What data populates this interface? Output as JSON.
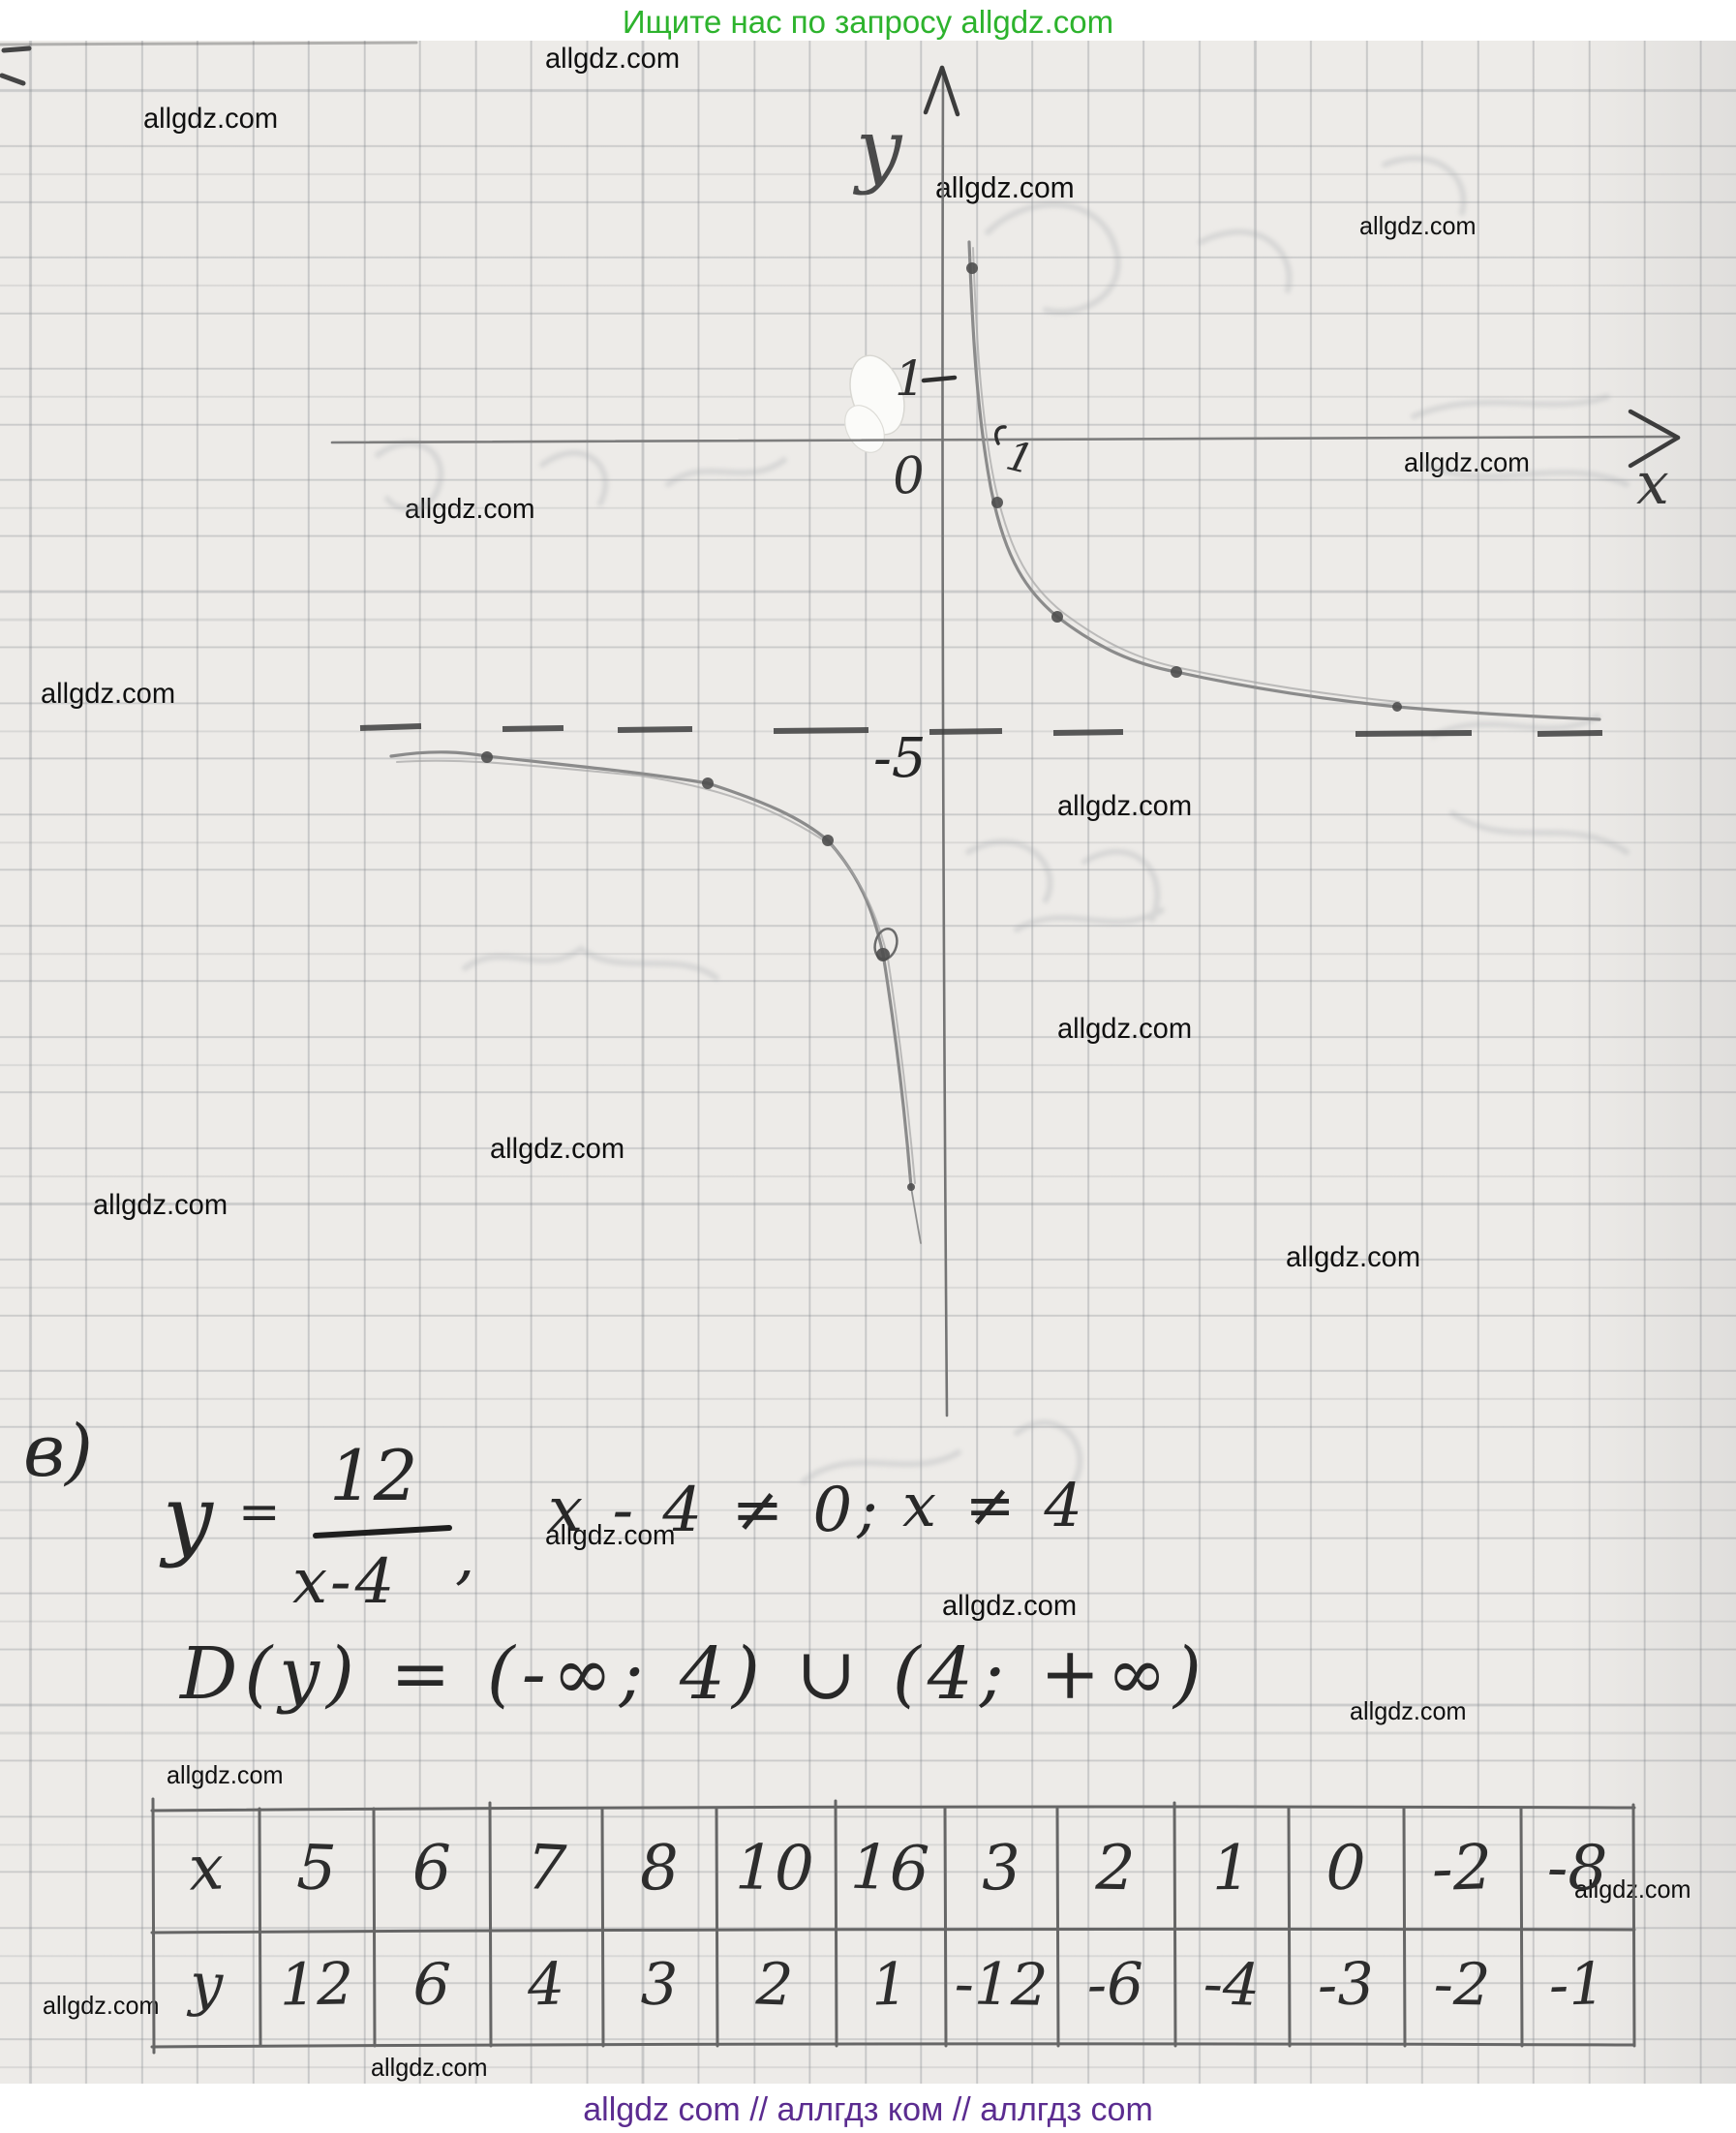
{
  "header": {
    "promo_text": "Ищите нас по запросу allgdz.com",
    "color": "#2db32d"
  },
  "watermark": {
    "text": "allgdz.com",
    "color": "#101010",
    "positions": [
      {
        "x": 563,
        "y": 44,
        "s": 30
      },
      {
        "x": 148,
        "y": 106,
        "s": 30
      },
      {
        "x": 966,
        "y": 176,
        "s": 31
      },
      {
        "x": 1404,
        "y": 218,
        "s": 26
      },
      {
        "x": 1450,
        "y": 462,
        "s": 28
      },
      {
        "x": 418,
        "y": 510,
        "s": 29
      },
      {
        "x": 42,
        "y": 700,
        "s": 30
      },
      {
        "x": 1092,
        "y": 816,
        "s": 30
      },
      {
        "x": 1092,
        "y": 1046,
        "s": 30
      },
      {
        "x": 506,
        "y": 1170,
        "s": 30
      },
      {
        "x": 96,
        "y": 1228,
        "s": 30
      },
      {
        "x": 1328,
        "y": 1282,
        "s": 30
      },
      {
        "x": 563,
        "y": 1570,
        "s": 29
      },
      {
        "x": 973,
        "y": 1642,
        "s": 30
      },
      {
        "x": 1394,
        "y": 1752,
        "s": 26
      },
      {
        "x": 172,
        "y": 1818,
        "s": 26
      },
      {
        "x": 1626,
        "y": 1936,
        "s": 26
      },
      {
        "x": 44,
        "y": 2056,
        "s": 26
      },
      {
        "x": 383,
        "y": 2120,
        "s": 26
      }
    ]
  },
  "graph": {
    "y_axis_label": "y",
    "x_axis_label": "x",
    "origin_label": "0",
    "y_unit_tick_label": "1",
    "x_unit_tick_label": "1",
    "dashed_level_label": "-5"
  },
  "work": {
    "part_label": "в)",
    "function_symbol": "y",
    "equals_sign": "=",
    "fraction_numerator": "12",
    "fraction_denominator": "x-4",
    "comma": ",",
    "condition": "x - 4 ≠ 0;",
    "conclusion": "x ≠ 4",
    "domain_line": "D(y) = (-∞; 4) ∪ (4; +∞)"
  },
  "table": {
    "row_labels": [
      "x",
      "y"
    ],
    "x_row": [
      "5",
      "6",
      "7",
      "8",
      "10",
      "16",
      "3",
      "2",
      "1",
      "0",
      "-2",
      "-8"
    ],
    "y_row": [
      "12",
      "6",
      "4",
      "3",
      "2",
      "1",
      "-12",
      "-6",
      "-4",
      "-3",
      "-2",
      "-1"
    ]
  },
  "chart_data": {
    "type": "line",
    "function": "y = 12/(x-4)",
    "series": [
      {
        "name": "branch x > 4",
        "x": [
          5,
          6,
          7,
          8,
          10,
          16
        ],
        "y": [
          12,
          6,
          4,
          3,
          2,
          1
        ]
      },
      {
        "name": "branch x < 4",
        "x": [
          3,
          2,
          1,
          0,
          -2,
          -8
        ],
        "y": [
          -12,
          -6,
          -4,
          -3,
          -2,
          -1
        ]
      }
    ],
    "axis_annotations": [
      "y",
      "x",
      "0",
      "1",
      "1",
      "-5"
    ],
    "grid": true
  },
  "footer": {
    "text": "allgdz com  //  аллгдз ком  //  аллгдз com",
    "color": "#5b2c90"
  }
}
